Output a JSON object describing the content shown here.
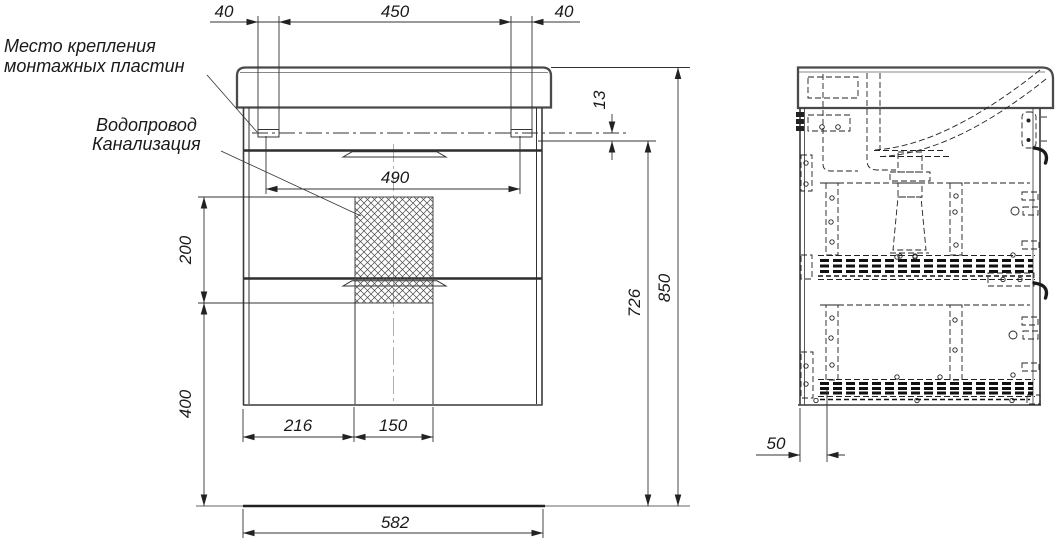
{
  "page": {
    "background": "#ffffff",
    "line_color": "#333333"
  },
  "annotations": {
    "mounting_label_line1": "Место крепления",
    "mounting_label_line2": "монтажных пластин",
    "plumbing_label_line1": "Водопровод",
    "plumbing_label_line2": "Канализация"
  },
  "front_view": {
    "dims": {
      "top_left_offset": "40",
      "top_span": "450",
      "top_right_offset": "40",
      "rim_to_top": "13",
      "mount_span": "490",
      "hatch_height": "200",
      "hatch_to_floor": "400",
      "left_to_hatch": "216",
      "hatch_width": "150",
      "wall_height": "726",
      "total_height": "850",
      "total_width": "582"
    }
  },
  "side_view": {
    "dims": {
      "back_offset": "50"
    }
  }
}
